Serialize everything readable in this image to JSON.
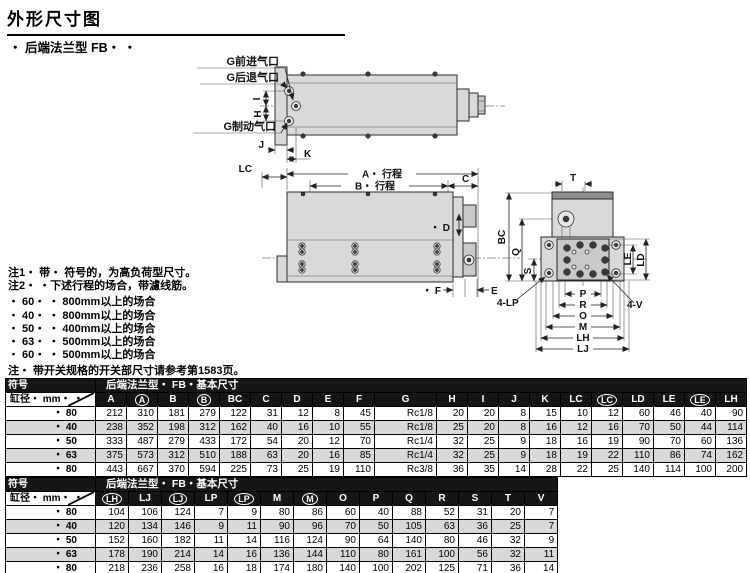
{
  "page": {
    "title": "外形尺寸图",
    "subtitle": "・ 后端法兰型  FB・ ・"
  },
  "drawing": {
    "labels": {
      "port_forward": "G前进气口",
      "port_retract": "G后退气口",
      "port_brake": "G制动气口",
      "i": "I",
      "h": "H",
      "j": "J",
      "k": "K",
      "lc": "LC",
      "a_stroke": "A・ 行程",
      "b_stroke": "B・ 行程",
      "c": "C",
      "d": "・ D",
      "f": "・ F",
      "e": "E",
      "t": "T",
      "bc": "BC",
      "q": "Q",
      "s": "S",
      "le": "LE",
      "ld": "LD",
      "lp4": "4-LP",
      "v4": "4-V",
      "p": "P",
      "r": "R",
      "o": "O",
      "m": "M",
      "lh": "LH",
      "lj": "LJ"
    }
  },
  "notes": {
    "note1": "注1・ 带・ 符号的，为高负荷型尺寸。",
    "note2": "注2・ ・下述行程的场合，带濾线筋。",
    "bullets": [
      "・ 60・ ・ 800mm以上的场合",
      "・ 40・ ・ 800mm以上的场合",
      "・ 50・ ・ 400mm以上的场合",
      "・ 63・ ・ 500mm以上的场合",
      "・ 60・ ・ 500mm以上的场合"
    ],
    "note3": "注・ 带开关规格的开关部尺寸请参考第1583页。"
  },
  "table1": {
    "corner": "符号",
    "banner": "后端法兰型・ FB・基本尺寸",
    "row_header": "缸径・ mm・ ・",
    "columns": [
      "A",
      "(A)",
      "B",
      "(B)",
      "BC",
      "C",
      "D",
      "E",
      "F",
      "G",
      "H",
      "I",
      "J",
      "K",
      "LC",
      "(LC)",
      "LD",
      "LE",
      "(LE)",
      "LH"
    ],
    "rows": [
      {
        "bore": "・ 80",
        "values": [
          "212",
          "310",
          "181",
          "279",
          "122",
          "31",
          "12",
          "8",
          "45",
          "Rc1/8",
          "20",
          "20",
          "8",
          "15",
          "10",
          "12",
          "60",
          "46",
          "40",
          "90"
        ]
      },
      {
        "bore": "・ 40",
        "values": [
          "238",
          "352",
          "198",
          "312",
          "162",
          "40",
          "16",
          "10",
          "55",
          "Rc1/8",
          "25",
          "20",
          "8",
          "16",
          "12",
          "16",
          "70",
          "50",
          "44",
          "114"
        ]
      },
      {
        "bore": "・ 50",
        "values": [
          "333",
          "487",
          "279",
          "433",
          "172",
          "54",
          "20",
          "12",
          "70",
          "Rc1/4",
          "32",
          "25",
          "9",
          "18",
          "16",
          "19",
          "90",
          "70",
          "60",
          "136"
        ]
      },
      {
        "bore": "・ 63",
        "values": [
          "375",
          "573",
          "312",
          "510",
          "188",
          "63",
          "20",
          "16",
          "85",
          "Rc1/4",
          "32",
          "25",
          "9",
          "18",
          "19",
          "22",
          "110",
          "86",
          "74",
          "162"
        ]
      },
      {
        "bore": "・ 80",
        "values": [
          "443",
          "667",
          "370",
          "594",
          "225",
          "73",
          "25",
          "19",
          "110",
          "Rc3/8",
          "36",
          "35",
          "14",
          "28",
          "22",
          "25",
          "140",
          "114",
          "100",
          "200"
        ]
      }
    ]
  },
  "table2": {
    "corner": "符号",
    "banner": "后端法兰型・ FB・基本尺寸",
    "row_header": "缸径・ mm・ ・",
    "columns": [
      "(LH)",
      "LJ",
      "(LJ)",
      "LP",
      "(LP)",
      "M",
      "(M)",
      "O",
      "P",
      "Q",
      "R",
      "S",
      "T",
      "V"
    ],
    "rows": [
      {
        "bore": "・ 80",
        "values": [
          "104",
          "106",
          "124",
          "7",
          "9",
          "80",
          "86",
          "60",
          "40",
          "88",
          "52",
          "31",
          "20",
          "7"
        ]
      },
      {
        "bore": "・ 40",
        "values": [
          "120",
          "134",
          "146",
          "9",
          "11",
          "90",
          "96",
          "70",
          "50",
          "105",
          "63",
          "36",
          "25",
          "7"
        ]
      },
      {
        "bore": "・ 50",
        "values": [
          "152",
          "160",
          "182",
          "11",
          "14",
          "116",
          "124",
          "90",
          "64",
          "140",
          "80",
          "46",
          "32",
          "9"
        ]
      },
      {
        "bore": "・ 63",
        "values": [
          "178",
          "190",
          "214",
          "14",
          "16",
          "136",
          "144",
          "110",
          "80",
          "161",
          "100",
          "56",
          "32",
          "11"
        ]
      },
      {
        "bore": "・ 80",
        "values": [
          "218",
          "236",
          "258",
          "16",
          "18",
          "174",
          "180",
          "140",
          "100",
          "202",
          "125",
          "71",
          "36",
          "14"
        ]
      }
    ]
  }
}
